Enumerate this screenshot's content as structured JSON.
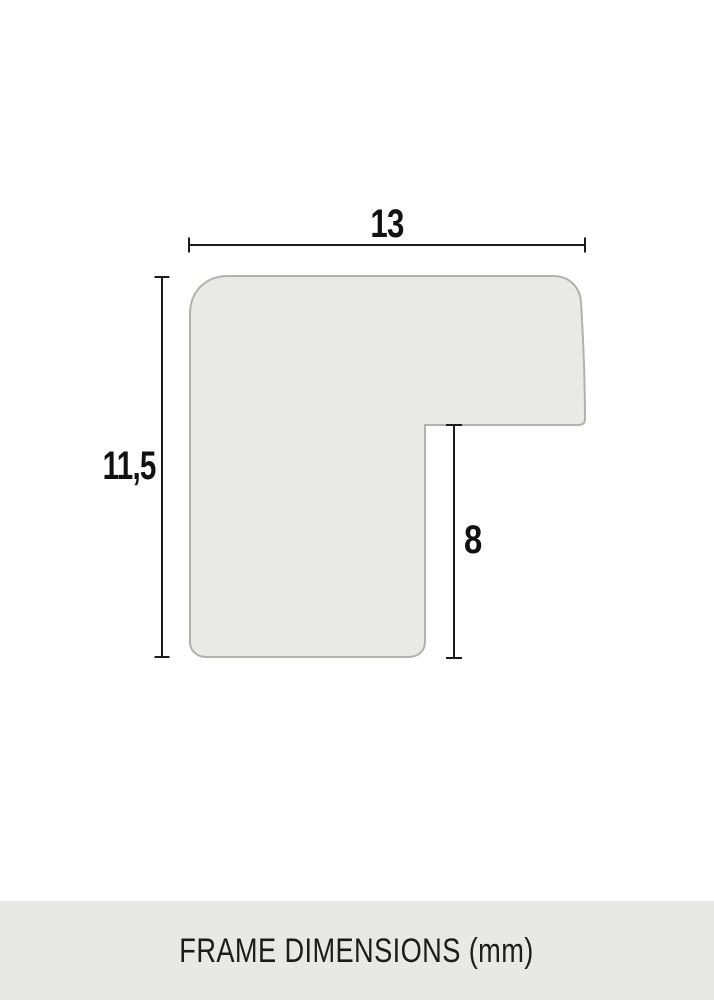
{
  "diagram": {
    "type": "picture-frame-profile-cross-section",
    "dimensions": {
      "width": {
        "value": "13"
      },
      "height": {
        "value": "11,5"
      },
      "rabbet": {
        "value": "8"
      }
    },
    "colors": {
      "shape_fill": "#e9e9e5",
      "shape_stroke": "#b2b2ad",
      "dimension_line": "#1c1c1c",
      "label_text": "#111111",
      "footer_bg": "#e8e8e4",
      "footer_text": "#1c1c1a",
      "page_bg": "#ffffff"
    }
  },
  "footer": {
    "caption": "FRAME DIMENSIONS (mm)"
  }
}
